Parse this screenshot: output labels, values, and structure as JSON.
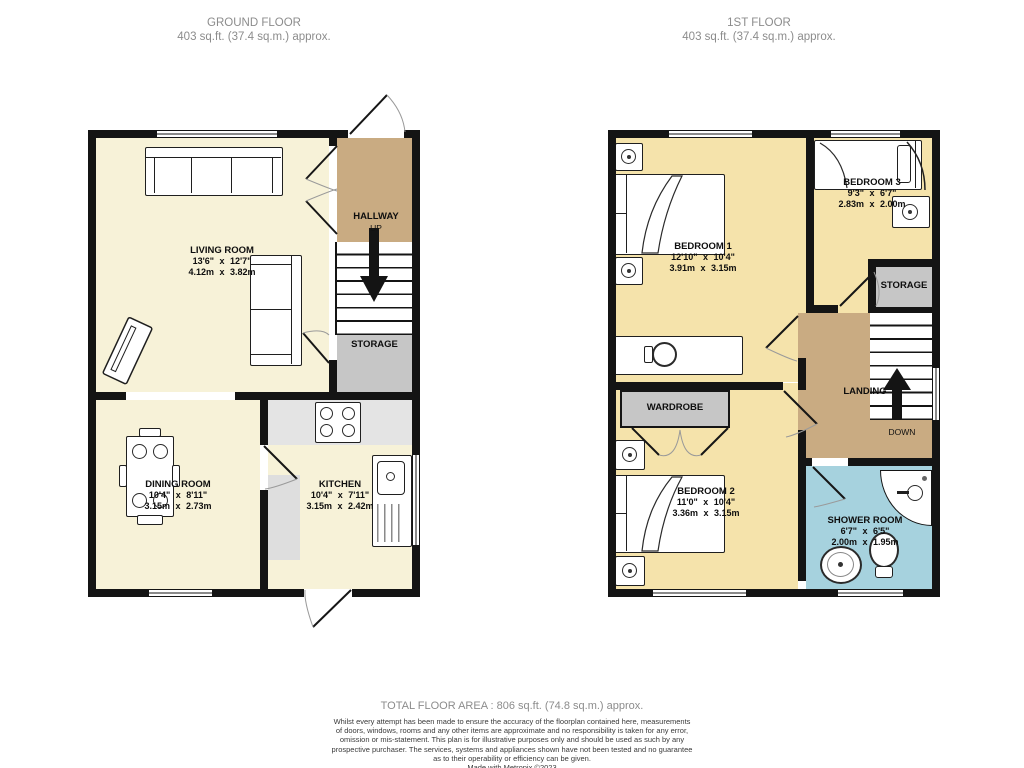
{
  "ground_floor": {
    "title": "GROUND FLOOR",
    "subtitle": "403 sq.ft. (37.4 sq.m.) approx.",
    "rooms": {
      "living_room": {
        "name": "LIVING ROOM",
        "imperial": "13'6\" x 12'7\"",
        "metric": "4.12m x 3.82m"
      },
      "hallway": {
        "name": "HALLWAY",
        "direction": "UP"
      },
      "storage": {
        "name": "STORAGE"
      },
      "dining_room": {
        "name": "DINING ROOM",
        "imperial": "10'4\" x 8'11\"",
        "metric": "3.15m x 2.73m"
      },
      "kitchen": {
        "name": "KITCHEN",
        "imperial": "10'4\" x 7'11\"",
        "metric": "3.15m x 2.42m"
      }
    }
  },
  "first_floor": {
    "title": "1ST FLOOR",
    "subtitle": "403 sq.ft. (37.4 sq.m.) approx.",
    "rooms": {
      "bedroom_1": {
        "name": "BEDROOM 1",
        "imperial": "12'10\" x 10'4\"",
        "metric": "3.91m x 3.15m"
      },
      "bedroom_2": {
        "name": "BEDROOM 2",
        "imperial": "11'0\" x 10'4\"",
        "metric": "3.36m x 3.15m"
      },
      "bedroom_3": {
        "name": "BEDROOM 3",
        "imperial": "9'3\" x 6'7\"",
        "metric": "2.83m x 2.00m"
      },
      "wardrobe": {
        "name": "WARDROBE"
      },
      "storage": {
        "name": "STORAGE"
      },
      "landing": {
        "name": "LANDING",
        "direction": "DOWN"
      },
      "shower_room": {
        "name": "SHOWER ROOM",
        "imperial": "6'7\" x 6'5\"",
        "metric": "2.00m x 1.95m"
      }
    }
  },
  "footer": {
    "total_area": "TOTAL FLOOR AREA : 806 sq.ft. (74.8 sq.m.) approx.",
    "disclaimer_lines": [
      "Whilst every attempt has been made to ensure the accuracy of the floorplan contained here, measurements",
      "of doors, windows, rooms and any other items are approximate and no responsibility is taken for any error,",
      "omission or mis-statement. This plan is for illustrative purposes only and should be used as such by any",
      "prospective purchaser. The services, systems and appliances shown have not been tested and no guarantee",
      "as to their operability or efficiency can be given."
    ],
    "credit": "Made with Metropix ©2023"
  },
  "colors": {
    "floor_cream": "#f7f2d8",
    "bedroom_yellow": "#f5e3ab",
    "hallway_tan": "#c9ab82",
    "storage_gray": "#c6c6c6",
    "counter_gray": "#e4e4e4",
    "shower_blue": "#a6d2de",
    "wall_black": "#141414",
    "title_gray": "#8c8c8c"
  }
}
